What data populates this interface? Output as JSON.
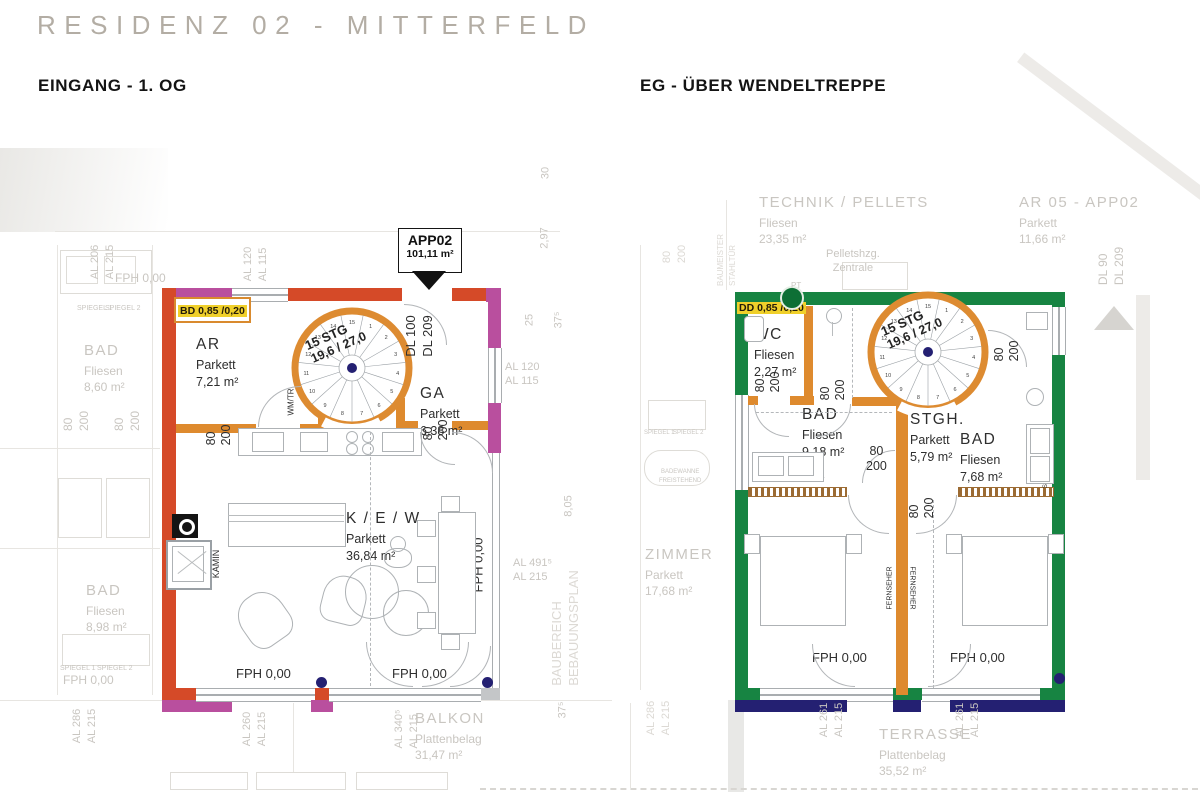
{
  "header": {
    "title": "RESIDENZ 02 - MITTERFELD"
  },
  "sections": {
    "left": "EINGANG - 1. OG",
    "right": "EG - ÜBER WENDELTREPPE"
  },
  "callout": {
    "id": "APP02",
    "area": "101,11 m²"
  },
  "stair": {
    "line1": "15 STG",
    "line2": "19,6 / 27,0",
    "steps": [
      "1",
      "2",
      "3",
      "4",
      "5",
      "6",
      "7",
      "8",
      "9",
      "10",
      "11",
      "12",
      "13",
      "14",
      "15"
    ]
  },
  "left_plan": {
    "lintel": "BD 0,85 /0,20",
    "door_labels": [
      "DL 100",
      "DL 209"
    ],
    "rooms": {
      "ar": {
        "name": "AR",
        "floor": "Parkett",
        "area": "7,21 m²"
      },
      "ga": {
        "name": "GA",
        "floor": "Parkett",
        "area": "6,38 m²"
      },
      "kew": {
        "name": "K / E / W",
        "floor": "Parkett",
        "area": "36,84 m²"
      }
    },
    "labels": {
      "wmtr": "WM/TR",
      "kamin": "KAMIN",
      "fph": "FPH 0,00"
    }
  },
  "right_plan": {
    "lintel": "DD 0,85 /0,20",
    "rooms": {
      "wc": {
        "name": "WC",
        "floor": "Fliesen",
        "area": "2,27 m²"
      },
      "bad1": {
        "name": "BAD",
        "floor": "Fliesen",
        "area": "9,18 m²"
      },
      "stgh": {
        "name": "STGH.",
        "floor": "Parkett",
        "area": "5,79 m²"
      },
      "bad2": {
        "name": "BAD",
        "floor": "Fliesen",
        "area": "7,68 m²"
      },
      "zimmer1": {
        "name": "ZIMMER",
        "floor": "Parkett",
        "area": "12,84 m²"
      },
      "zimmer2": {
        "name": "ZIMMER",
        "floor": "Parkett",
        "area": "12,87 m²"
      }
    },
    "labels": {
      "spiegel2": "SPIEGEL 2",
      "spiegel1": "SPIEGEL 1",
      "spiegel_combo": "SPIEGEL 1, SPIEGEL 2",
      "fernseher": "FERNSEHER",
      "fph": "FPH 0,00"
    }
  },
  "dims": [
    [
      "80",
      "200"
    ],
    [
      "80",
      "200"
    ],
    [
      "80",
      "200"
    ],
    [
      "80",
      "200"
    ],
    [
      "80",
      "200"
    ],
    [
      "80",
      "200"
    ],
    [
      "80",
      "200"
    ]
  ],
  "faded": [
    [
      "AL 206",
      "AL 215"
    ],
    [
      "FPH 0,00"
    ],
    [
      "SPIEGEL 1"
    ],
    [
      "SPIEGEL 2"
    ],
    [
      "BAD",
      "Fliesen",
      "8,60 m²"
    ],
    [
      "80",
      "200"
    ],
    [
      "80",
      "200"
    ],
    [
      "BAD",
      "Fliesen",
      "8,98 m²"
    ],
    [
      "SPIEGEL 1"
    ],
    [
      "SPIEGEL 2"
    ],
    [
      "FPH 0,00"
    ],
    [
      "AL 286",
      "AL 215"
    ],
    [
      "AL 120",
      "AL 115"
    ],
    [
      "30"
    ],
    [
      "2,97"
    ],
    [
      "25"
    ],
    [
      "37⁵"
    ],
    [
      "AL 120",
      "AL 115"
    ],
    [
      "8,05"
    ],
    [
      "AL 491⁵",
      "AL 215"
    ],
    [
      "BAUBEREICH",
      "BEBAUUNGSPLAN"
    ],
    [
      "37⁵"
    ],
    [
      "AL 260",
      "AL 215"
    ],
    [
      "AL 340⁵",
      "AL 215"
    ],
    [
      "BALKON",
      "Plattenbelag",
      "31,47 m²"
    ],
    [
      "TECHNIK / PELLETS",
      "Fliesen",
      "23,35 m²"
    ],
    [
      "Pelletshzg.",
      "Zentrale"
    ],
    [
      "BAUMEISTER",
      "STAHLTÜR"
    ],
    [
      "80",
      "200"
    ],
    [
      "PT"
    ],
    [
      "AR 05 - APP02",
      "Parkett",
      "11,66 m²"
    ],
    [
      "DL 90",
      "DL 209"
    ],
    [
      "ZIMMER",
      "Parkett",
      "17,68 m²"
    ],
    [
      "SPIEGEL 1"
    ],
    [
      "SPIEGEL 2"
    ],
    [
      "BADEWANNE",
      "FREISTEHEND"
    ],
    [
      "AL 261",
      "AL 215"
    ],
    [
      "AL 261",
      "AL 215"
    ],
    [
      "TERRASSE",
      "Plattenbelag",
      "35,52 m²"
    ],
    [
      "AL 286",
      "AL 215"
    ]
  ],
  "colors": {
    "wall_red": "#d54a28",
    "wall_magenta": "#b94f9e",
    "wall_green": "#178442",
    "wall_orange": "#de8a2e",
    "wall_navy": "#242072",
    "highlight_yellow": "#f0d02a",
    "faded_text": "#c9c6c1",
    "dark_text": "#2e2e2e"
  }
}
